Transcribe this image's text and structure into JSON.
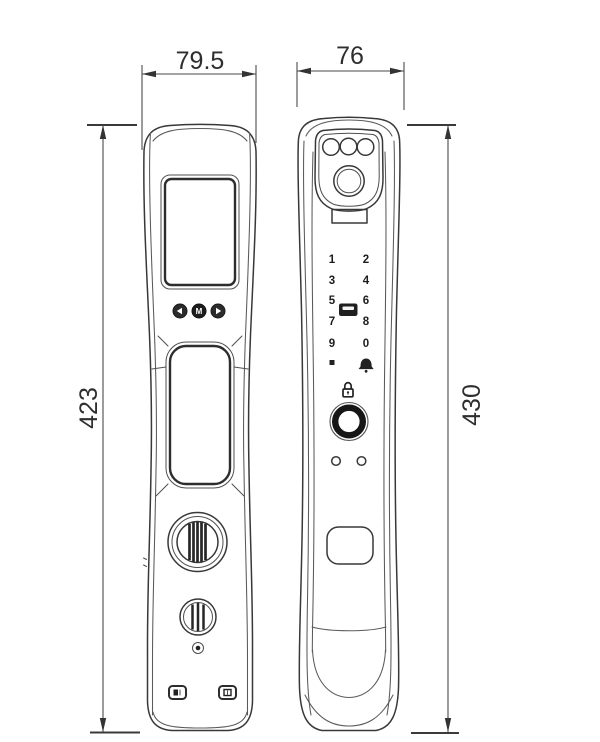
{
  "dimensions": {
    "front_panel_width": "79.5",
    "front_panel_height": "423",
    "rear_panel_width": "76",
    "rear_panel_height": "430"
  },
  "front_panel": {
    "nav_buttons": {
      "back_icon": "left-arrow",
      "menu_label": "M",
      "forward_icon": "right-arrow"
    },
    "icons": [
      "display-screen",
      "handle-recess",
      "thumb-turn-knob",
      "battery-knob",
      "screw",
      "port-left",
      "port-right"
    ]
  },
  "rear_panel": {
    "keypad": {
      "keys": [
        "1",
        "2",
        "3",
        "4",
        "5",
        "6",
        "7",
        "8",
        "9",
        "0"
      ],
      "star_key_icon": "filled-square",
      "bell_key_icon": "doorbell-bell",
      "card_reader_icon": "rfid-card"
    },
    "icons": [
      "camera-leds",
      "camera-lens",
      "sensor-window",
      "padlock",
      "fingerprint-ring",
      "indicator-dots",
      "key-cover"
    ]
  },
  "colors": {
    "line": "#383838",
    "dim_line": "#4a4a4a",
    "dark_fill": "#222222",
    "background": "#ffffff"
  }
}
